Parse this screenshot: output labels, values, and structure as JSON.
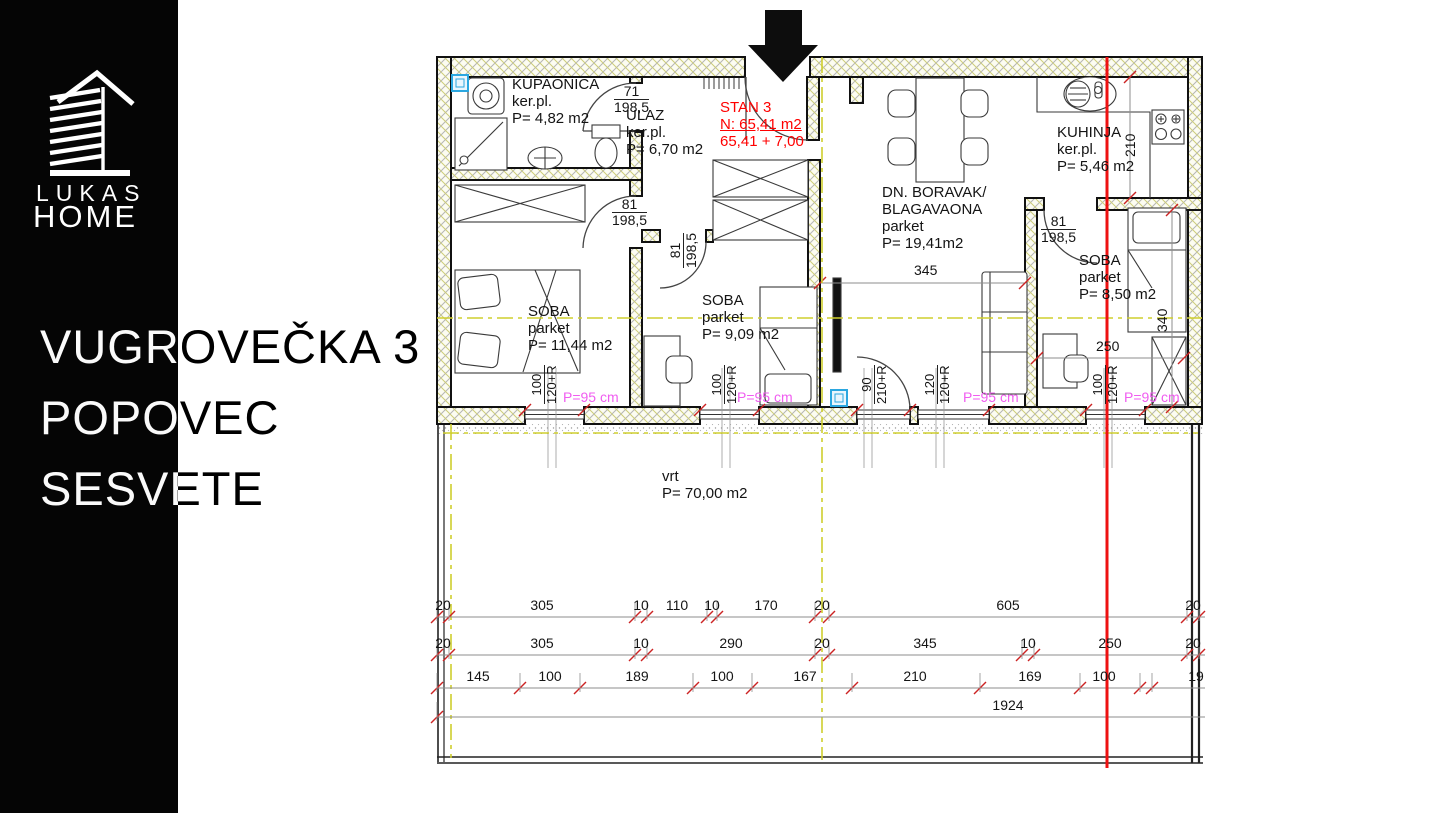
{
  "sidebar": {
    "brand": {
      "line1": "LUKAS",
      "line2": "HOME"
    },
    "title_lines": [
      "VUGROVEČKA 3",
      "POPOVEC",
      "SESVETE"
    ]
  },
  "colors": {
    "text_red": "#ff0000",
    "pink": "#f05df0",
    "tick_red": "#cc2323",
    "axis_yellow": "#cfcf2e",
    "marker_red_line": "#ee1111",
    "sidebar_black": "#050505"
  },
  "plan": {
    "blocks": [
      {
        "id": "kupaonica",
        "x": 512,
        "y": 76,
        "lines": [
          "KUPAONICA",
          "ker.pl.",
          "P= 4,82 m2"
        ]
      },
      {
        "id": "ulaz",
        "x": 626,
        "y": 107,
        "lines": [
          "ULAZ",
          "ker.pl.",
          "P= 6,70 m2"
        ]
      },
      {
        "id": "stan3",
        "x": 720,
        "y": 99,
        "cls": "red",
        "ul": 1,
        "lines": [
          "STAN 3",
          "N: 65,41 m2",
          "65,41 + 7,00"
        ]
      },
      {
        "id": "dnevni-boravak",
        "x": 882,
        "y": 184,
        "lines": [
          "DN. BORAVAK/",
          "BLAGAVAONA",
          "parket",
          "P= 19,41m2"
        ]
      },
      {
        "id": "kuhinja",
        "x": 1057,
        "y": 124,
        "lines": [
          "KUHINJA",
          "ker.pl.",
          "P= 5,46 m2"
        ]
      },
      {
        "id": "soba-1",
        "x": 528,
        "y": 303,
        "lines": [
          "SOBA",
          "parket",
          "P= 11,44 m2"
        ]
      },
      {
        "id": "soba-2",
        "x": 702,
        "y": 292,
        "lines": [
          "SOBA",
          "parket",
          "P= 9,09 m2"
        ]
      },
      {
        "id": "soba-3",
        "x": 1079,
        "y": 252,
        "lines": [
          "SOBA",
          "parket",
          "P= 8,50 m2"
        ]
      },
      {
        "id": "vrt",
        "x": 662,
        "y": 468,
        "lines": [
          "vrt",
          "P= 70,00 m2"
        ]
      }
    ],
    "fractions": [
      {
        "top": "71",
        "bottom": "198,5",
        "x": 614,
        "y": 84,
        "rot": 0
      },
      {
        "top": "81",
        "bottom": "198,5",
        "x": 612,
        "y": 197,
        "rot": 0
      },
      {
        "top": "81",
        "bottom": "198,5",
        "x": 668,
        "y": 268,
        "rot": 1
      },
      {
        "top": "81",
        "bottom": "198,5",
        "x": 1041,
        "y": 214,
        "rot": 0
      }
    ],
    "dims": [
      {
        "t": "345",
        "x": 914,
        "y": 262,
        "rot": 0
      },
      {
        "t": "250",
        "x": 1096,
        "y": 338,
        "rot": 0
      },
      {
        "t": "210",
        "x": 1122,
        "y": 157,
        "rot": 1
      },
      {
        "t": "340",
        "x": 1154,
        "y": 332,
        "rot": 1
      }
    ],
    "window_dims": [
      {
        "a": "100",
        "b": "120+R",
        "x": 530,
        "y": 404
      },
      {
        "a": "100",
        "b": "120+R",
        "x": 710,
        "y": 404
      },
      {
        "a": "90",
        "b": "210+R",
        "x": 860,
        "y": 404
      },
      {
        "a": "120",
        "b": "120+R",
        "x": 923,
        "y": 404
      },
      {
        "a": "100",
        "b": "120+R",
        "x": 1091,
        "y": 404
      }
    ],
    "pink_labels": [
      {
        "text": "P=95 cm",
        "x": 563,
        "y": 389
      },
      {
        "text": "P=95 cm",
        "x": 737,
        "y": 389
      },
      {
        "text": "P=95 cm",
        "x": 963,
        "y": 389
      },
      {
        "text": "P=95 cm",
        "x": 1124,
        "y": 389
      }
    ],
    "dim_rows": [
      {
        "y": 617,
        "labels": [
          {
            "t": "20",
            "x": 443
          },
          {
            "t": "305",
            "x": 542
          },
          {
            "t": "10",
            "x": 641
          },
          {
            "t": "110",
            "x": 677
          },
          {
            "t": "10",
            "x": 712
          },
          {
            "t": "170",
            "x": 766
          },
          {
            "t": "20",
            "x": 822
          },
          {
            "t": "605",
            "x": 1008
          },
          {
            "t": "20",
            "x": 1193
          }
        ],
        "ticks": [
          437,
          449,
          635,
          647,
          707,
          717,
          815,
          829,
          1187,
          1199
        ]
      },
      {
        "y": 655,
        "labels": [
          {
            "t": "20",
            "x": 443
          },
          {
            "t": "305",
            "x": 542
          },
          {
            "t": "10",
            "x": 641
          },
          {
            "t": "290",
            "x": 731
          },
          {
            "t": "20",
            "x": 822
          },
          {
            "t": "345",
            "x": 925
          },
          {
            "t": "10",
            "x": 1028
          },
          {
            "t": "250",
            "x": 1110
          },
          {
            "t": "20",
            "x": 1193
          }
        ],
        "ticks": [
          437,
          449,
          635,
          647,
          815,
          829,
          1022,
          1034,
          1187,
          1199
        ]
      },
      {
        "y": 688,
        "labels": [
          {
            "t": "145",
            "x": 478
          },
          {
            "t": "100",
            "x": 550
          },
          {
            "t": "189",
            "x": 637
          },
          {
            "t": "100",
            "x": 722
          },
          {
            "t": "167",
            "x": 805
          },
          {
            "t": "210",
            "x": 915
          },
          {
            "t": "169",
            "x": 1030
          },
          {
            "t": "100",
            "x": 1104
          },
          {
            "t": "19",
            "x": 1196
          }
        ],
        "ticks": [
          437,
          520,
          580,
          693,
          752,
          852,
          980,
          1080,
          1140,
          1152
        ]
      },
      {
        "y": 717,
        "labels": [
          {
            "t": "1924",
            "x": 1008
          }
        ],
        "ticks": [
          437
        ]
      }
    ]
  }
}
